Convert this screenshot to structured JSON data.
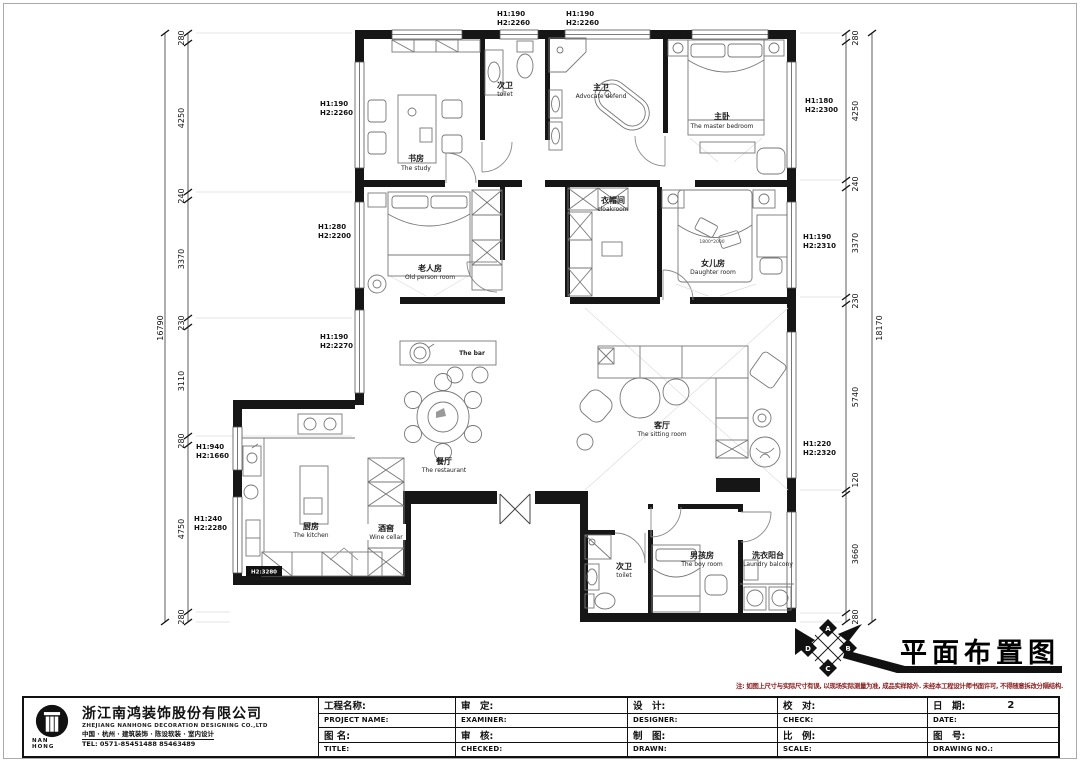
{
  "dims": {
    "left": {
      "total": "16790",
      "segs": [
        "280",
        "4250",
        "240",
        "3370",
        "230",
        "3110",
        "280",
        "4750",
        "280"
      ]
    },
    "right": {
      "total": "18170",
      "segs": [
        "280",
        "4250",
        "240",
        "3370",
        "230",
        "5740",
        "120",
        "3660",
        "280"
      ]
    }
  },
  "h_labels": {
    "top1": {
      "l1": "H1:190",
      "l2": "H2:2260"
    },
    "top2": {
      "l1": "H1:190",
      "l2": "H2:2260"
    },
    "left1": {
      "l1": "H1:190",
      "l2": "H2:2260"
    },
    "left2": {
      "l1": "H1:280",
      "l2": "H2:2200"
    },
    "left3": {
      "l1": "H1:190",
      "l2": "H2:2270"
    },
    "left4": {
      "l1": "H1:940",
      "l2": "H2:1660"
    },
    "left5": {
      "l1": "H1:240",
      "l2": "H2:2280"
    },
    "right1": {
      "l1": "H1:180",
      "l2": "H2:2300"
    },
    "right2": {
      "l1": "H1:190",
      "l2": "H2:2310"
    },
    "right3": {
      "l1": "H1:220",
      "l2": "H2:2320"
    }
  },
  "rooms": {
    "study": {
      "zh": "书房",
      "en": "The study"
    },
    "toilet_top": {
      "zh": "次卫",
      "en": "toilet"
    },
    "master_bath": {
      "zh": "主卫",
      "en": "Advocate defend"
    },
    "master_bedroom": {
      "zh": "主卧",
      "en": "The master bedroom"
    },
    "old_person": {
      "zh": "老人房",
      "en": "Old person room"
    },
    "cloakroom": {
      "zh": "衣帽间",
      "en": "cloakroom"
    },
    "daughter": {
      "zh": "女儿房",
      "en": "Daughter room"
    },
    "bar": {
      "en": "The bar"
    },
    "restaurant": {
      "zh": "餐厅",
      "en": "The restaurant"
    },
    "sitting": {
      "zh": "客厅",
      "en": "The sitting room"
    },
    "kitchen": {
      "zh": "厨房",
      "en": "The kitchen"
    },
    "wine": {
      "zh": "酒窖",
      "en": "Wine cellar"
    },
    "toilet_bottom": {
      "zh": "次卫",
      "en": "toilet"
    },
    "boy": {
      "zh": "男孩房",
      "en": "The boy room"
    },
    "laundry": {
      "zh": "洗衣阳台",
      "en": "Laundry balcony"
    }
  },
  "misc": {
    "bed_size": "1800*2000",
    "beam_tag": "H2:3280"
  },
  "title_area": {
    "drawing_title": "平面布置图",
    "note": "注: 如图上尺寸与实际尺寸有误, 以现场实际测量为准, 成品实样除外. 未经本工程设计师书面许可, 不得随意拆改分隔结构.",
    "compass": [
      "A",
      "B",
      "C",
      "D"
    ]
  },
  "titleblock": {
    "company": {
      "logo_sub": "NAN HONG",
      "name_zh": "浙江南鸿装饰股份有限公司",
      "name_en": "ZHEJIANG NANHONG DECORATION DESIGNING CO.,LTD",
      "services": "中国 · 杭州 · 建筑装饰 · 陈设软装 · 室内设计",
      "tel": "TEL: 0571-85451488 85463489"
    },
    "fields": {
      "project_zh": "工程名称:",
      "project_en": "PROJECT NAME:",
      "title_zh": "图 名:",
      "title_en": "TITLE:",
      "examine_zh": "审　定:",
      "examine_en": "EXAMINER:",
      "check2_zh": "审　核:",
      "check2_en": "CHECKED:",
      "design_zh": "设　计:",
      "design_en": "DESIGNER:",
      "draw_zh": "制　图:",
      "draw_en": "DRAWN:",
      "proof_zh": "校　对:",
      "proof_en": "CHECK:",
      "scale_zh": "比　例:",
      "scale_en": "SCALE:",
      "date_zh": "日　期:",
      "date_en": "DATE:",
      "date_value": "2",
      "no_zh": "图　号:",
      "no_en": "DRAWING NO.:"
    }
  }
}
